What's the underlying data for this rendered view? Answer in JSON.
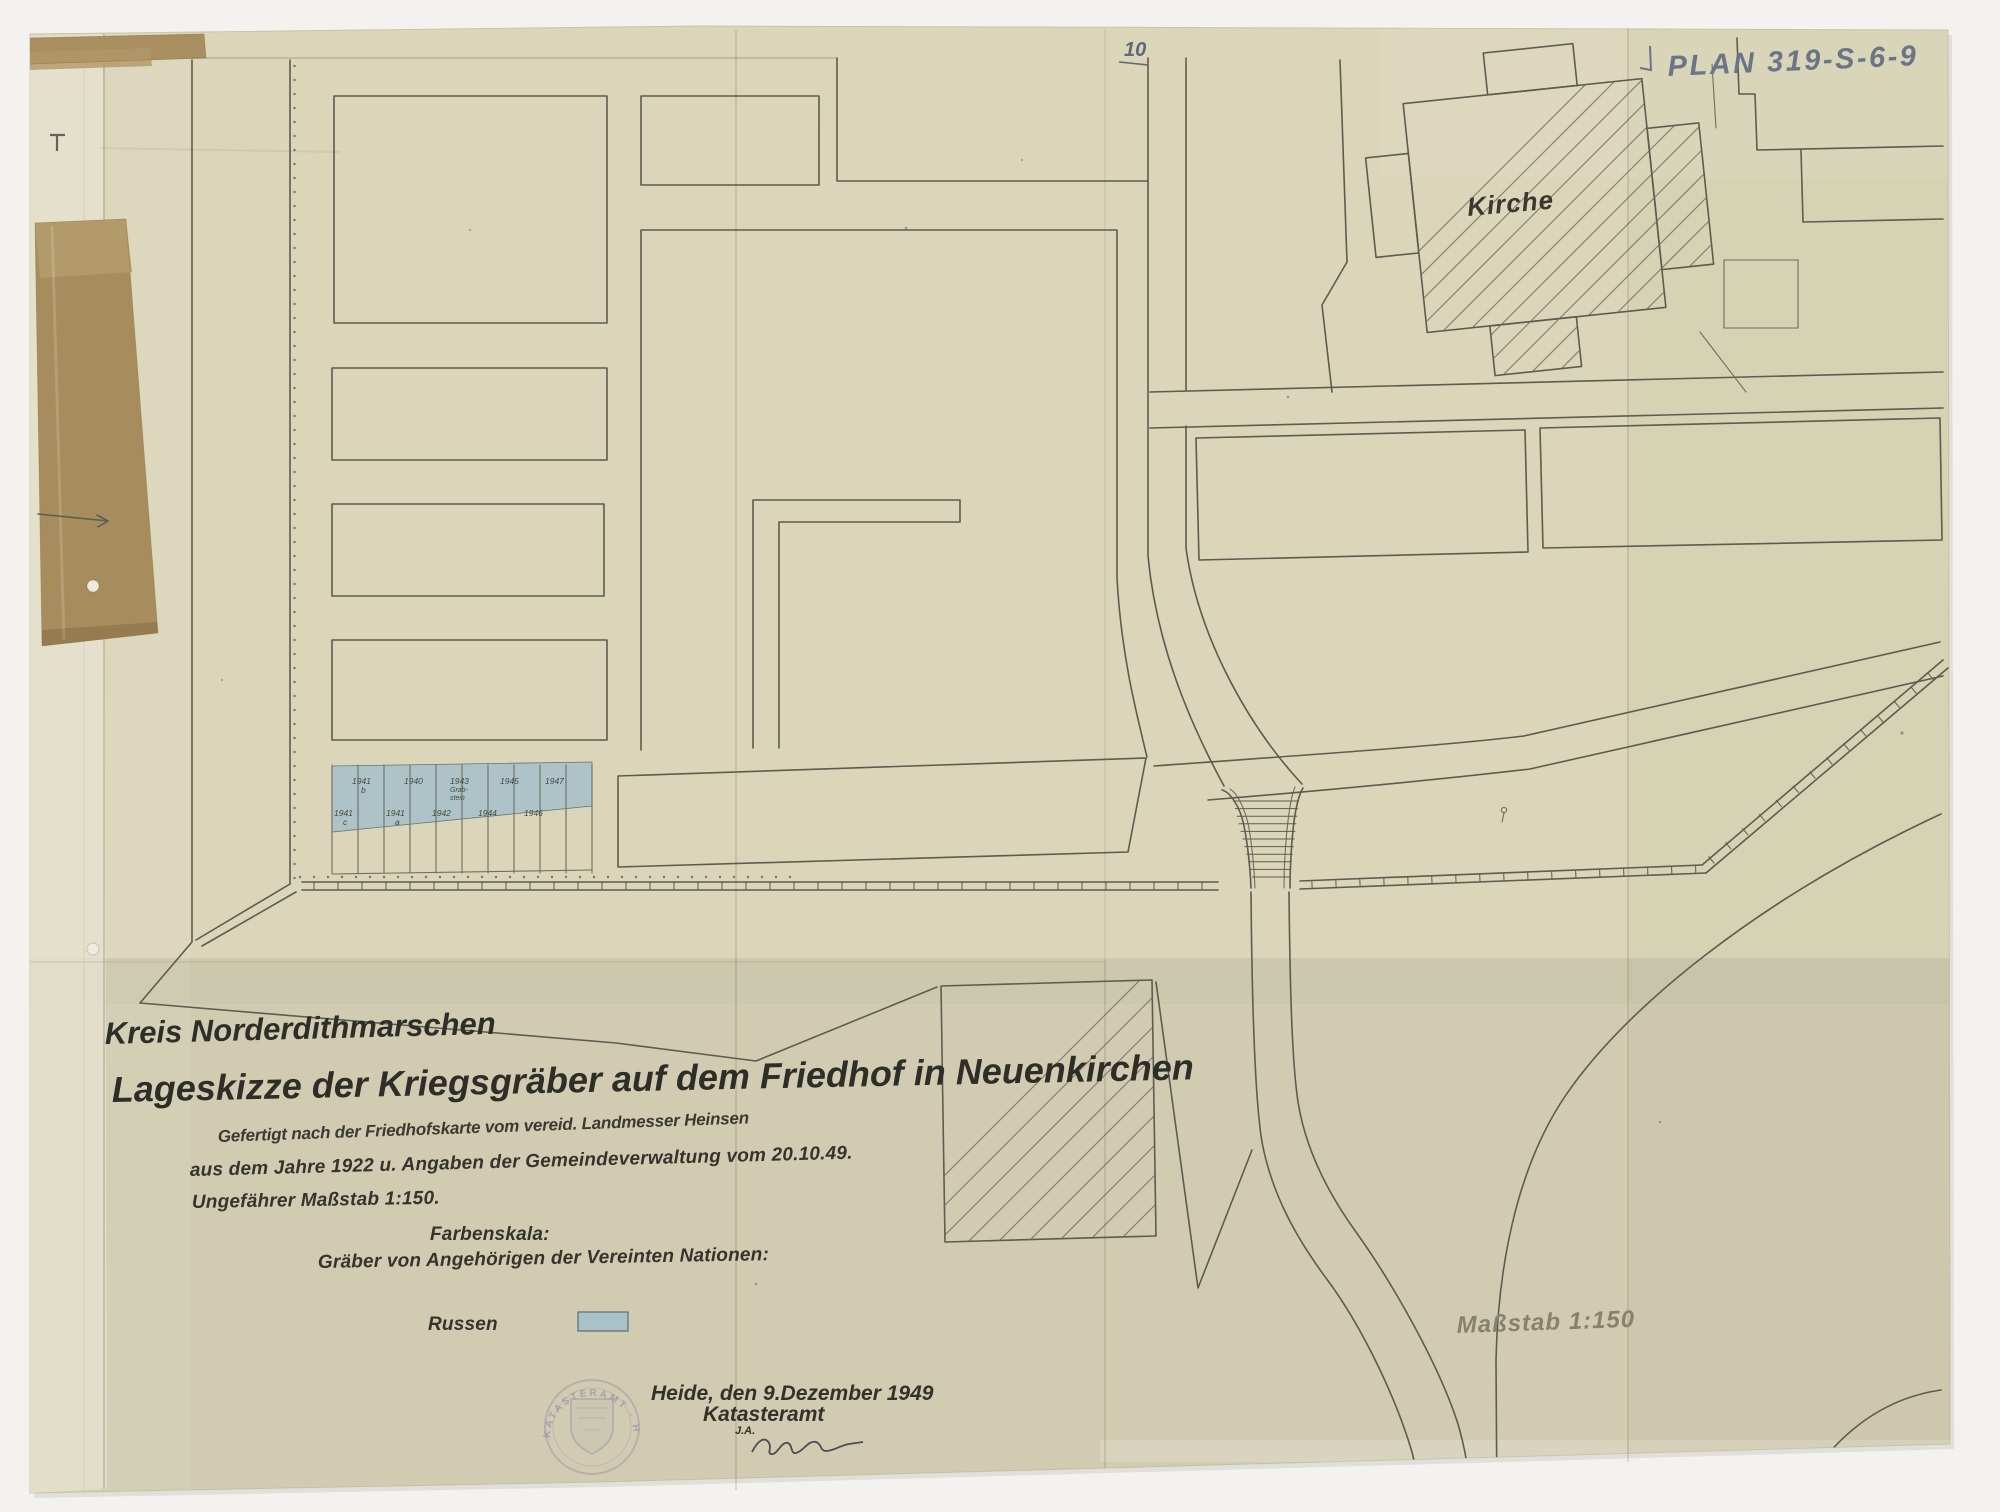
{
  "document": {
    "archive_number": "PLAN 319-S-6-9",
    "sheet_number": "10",
    "title_line1": "Kreis Norderdithmarschen",
    "title_line2": "Lageskizze der Kriegsgräber auf dem Friedhof in Neuenkirchen",
    "source_note_line1": "Gefertigt nach der Friedhofskarte vom vereid. Landmesser Heinsen",
    "source_note_line2": "aus dem Jahre 1922 u. Angaben der Gemeindeverwaltung vom 20.10.49.",
    "source_note_line3": "Ungefährer Maßstab 1:150.",
    "legend_heading": "Farbenskala:",
    "legend_subheading": "Gräber von Angehörigen der Vereinten Nationen:",
    "legend_entries": [
      {
        "label": "Russen",
        "color": "#a9c1c9"
      }
    ],
    "scale_note": "Maßstab 1:150",
    "dateline": "Heide, den 9.Dezember 1949",
    "office": "Katasteramt",
    "office_initials": "J.A.",
    "stamp_text": "KATASTERAMT · HEIDE"
  },
  "map": {
    "church_label": "Kirche",
    "grave_plot_labels": {
      "top_row": [
        {
          "text": "1941",
          "sub": "b",
          "x": 352
        },
        {
          "text": "1940",
          "x": 404
        },
        {
          "text": "1943",
          "sub": "Grab-|stein",
          "x": 450
        },
        {
          "text": "1945",
          "x": 500
        },
        {
          "text": "1947",
          "x": 545
        }
      ],
      "bottom_row": [
        {
          "text": "1941",
          "sub": "c",
          "x": 334
        },
        {
          "text": "1941",
          "sub": "a",
          "x": 386
        },
        {
          "text": "1942",
          "x": 432
        },
        {
          "text": "1944",
          "x": 478
        },
        {
          "text": "1946",
          "x": 524
        }
      ]
    }
  },
  "colors": {
    "paper": "#dbd6b9",
    "scan_background": "#f3f2ef",
    "ink": "#5c5c50",
    "title_ink": "#2e2e28",
    "grave_fill": "#a9c1c9",
    "pencil_gray": "#87826f",
    "pencil_blue": "#6b7585",
    "stamp_violet": "#8f89a6",
    "tape_brown": "#a78d5e"
  }
}
